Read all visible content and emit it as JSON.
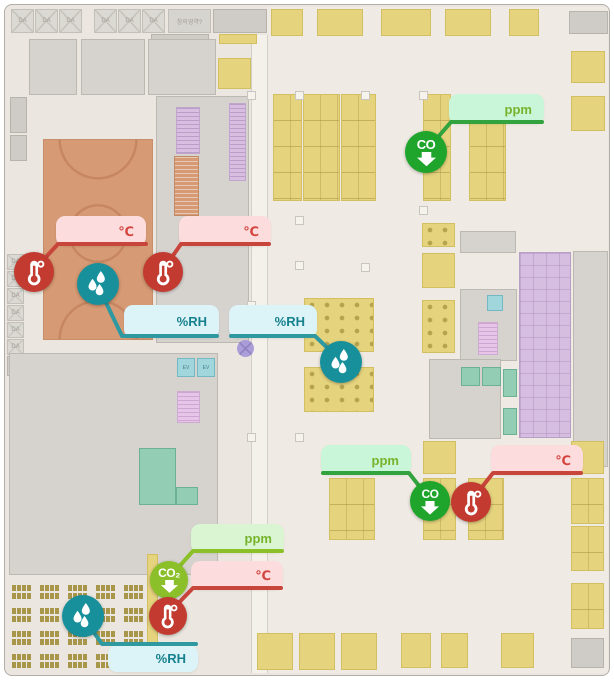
{
  "window": {
    "type": "facility-floor-plan-monitoring-view"
  },
  "labels": {
    "da": "DA",
    "ev": "EV",
    "co": "CO",
    "co2": "CO₂",
    "top_strip_text": "창의영역?"
  },
  "units": {
    "temperature": "℃",
    "humidity": "%RH",
    "gas": "ppm"
  },
  "palette": {
    "temperature": {
      "marker": "#c23a30",
      "bubble": "#fcdcdc",
      "text": "#d4453f",
      "line": "#c8453c"
    },
    "humidity": {
      "marker": "#17909b",
      "bubble": "#dcf3f8",
      "text": "#17818d",
      "line": "#2f99a2"
    },
    "co": {
      "marker": "#1fa52c",
      "bubble": "#c9f6d9",
      "text": "#76b32b",
      "line": "#33a33f"
    },
    "co2": {
      "marker": "#8cc02a",
      "bubble": "#d9f5d2",
      "text": "#76b32b",
      "line": "#8cc029"
    }
  },
  "map_colors": {
    "floor": "#ebe7e0",
    "room_grey": "#d6d3cf",
    "table": "#e5d37d",
    "gym": "#d69a74",
    "purple": "#d6bee0",
    "teal": "#92cdb4",
    "seat": "#a8974b",
    "cyan": "#a2d6dd"
  },
  "plan": {
    "rects": [
      {
        "k": "floor-light",
        "x": 266,
        "y": 6,
        "w": 341,
        "h": 666
      },
      {
        "k": "corridor",
        "x": 250,
        "y": 34,
        "w": 17,
        "h": 638
      },
      {
        "k": "box-da",
        "x": 10,
        "y": 8,
        "w": 23,
        "h": 24,
        "label": "DA"
      },
      {
        "k": "box-da",
        "x": 34,
        "y": 8,
        "w": 23,
        "h": 24,
        "label": "DA"
      },
      {
        "k": "box-da",
        "x": 58,
        "y": 8,
        "w": 23,
        "h": 24,
        "label": "DA"
      },
      {
        "k": "box-da",
        "x": 93,
        "y": 8,
        "w": 23,
        "h": 24,
        "label": "DA"
      },
      {
        "k": "box-da",
        "x": 117,
        "y": 8,
        "w": 23,
        "h": 24,
        "label": "DA"
      },
      {
        "k": "box-da",
        "x": 141,
        "y": 8,
        "w": 23,
        "h": 24,
        "label": "DA"
      },
      {
        "k": "box-label",
        "x": 167,
        "y": 8,
        "w": 43,
        "h": 24,
        "label": "창의영역?"
      },
      {
        "k": "room-grey-dark",
        "x": 212,
        "y": 8,
        "w": 54,
        "h": 24
      },
      {
        "k": "room-grey-dark",
        "x": 150,
        "y": 33,
        "w": 58,
        "h": 10
      },
      {
        "k": "table",
        "x": 218,
        "y": 33,
        "w": 38,
        "h": 10
      },
      {
        "k": "room-grey",
        "x": 28,
        "y": 38,
        "w": 48,
        "h": 56
      },
      {
        "k": "room-grey",
        "x": 80,
        "y": 38,
        "w": 64,
        "h": 56
      },
      {
        "k": "room-grey",
        "x": 147,
        "y": 38,
        "w": 68,
        "h": 56
      },
      {
        "k": "table",
        "x": 217,
        "y": 57,
        "w": 33,
        "h": 31
      },
      {
        "k": "room-grey-dark",
        "x": 9,
        "y": 96,
        "w": 17,
        "h": 36
      },
      {
        "k": "room-grey-dark",
        "x": 9,
        "y": 134,
        "w": 17,
        "h": 26
      },
      {
        "k": "box-da",
        "x": 6,
        "y": 253,
        "w": 17,
        "h": 16,
        "label": "DA"
      },
      {
        "k": "box-da",
        "x": 6,
        "y": 270,
        "w": 17,
        "h": 16,
        "label": "DA"
      },
      {
        "k": "box-da",
        "x": 6,
        "y": 287,
        "w": 17,
        "h": 16,
        "label": "DA"
      },
      {
        "k": "box-da",
        "x": 6,
        "y": 304,
        "w": 17,
        "h": 16,
        "label": "DA"
      },
      {
        "k": "box-da",
        "x": 6,
        "y": 321,
        "w": 17,
        "h": 16,
        "label": "DA"
      },
      {
        "k": "box-da",
        "x": 6,
        "y": 338,
        "w": 17,
        "h": 16,
        "label": "DA"
      },
      {
        "k": "room-grey-dark",
        "x": 6,
        "y": 355,
        "w": 18,
        "h": 20
      },
      {
        "k": "gym",
        "x": 42,
        "y": 138,
        "w": 110,
        "h": 201
      },
      {
        "k": "room-grey",
        "x": 155,
        "y": 95,
        "w": 93,
        "h": 247
      },
      {
        "k": "stairs-lav",
        "x": 175,
        "y": 106,
        "w": 24,
        "h": 47
      },
      {
        "k": "stairs-lav",
        "x": 228,
        "y": 102,
        "w": 17,
        "h": 78
      },
      {
        "k": "esc-orange",
        "x": 173,
        "y": 155,
        "w": 25,
        "h": 60
      },
      {
        "k": "room-grey",
        "x": 8,
        "y": 352,
        "w": 209,
        "h": 222
      },
      {
        "k": "elev-cyan",
        "x": 176,
        "y": 357,
        "w": 18,
        "h": 19,
        "label": "EV"
      },
      {
        "k": "elev-cyan",
        "x": 196,
        "y": 357,
        "w": 18,
        "h": 19,
        "label": "EV"
      },
      {
        "k": "stairs-pink",
        "x": 176,
        "y": 390,
        "w": 23,
        "h": 32
      },
      {
        "k": "teal",
        "x": 138,
        "y": 447,
        "w": 37,
        "h": 57
      },
      {
        "k": "teal",
        "x": 175,
        "y": 486,
        "w": 22,
        "h": 18
      },
      {
        "k": "seats-grid",
        "x": 10,
        "y": 583,
        "cols": 5,
        "rows": 4,
        "dx": 28,
        "dy": 23,
        "w": 24,
        "h": 16
      },
      {
        "k": "table",
        "x": 146,
        "y": 553,
        "w": 11,
        "h": 117
      },
      {
        "k": "xcircle",
        "x": 236,
        "y": 339,
        "w": 17,
        "h": 17
      },
      {
        "k": "table",
        "x": 270,
        "y": 8,
        "w": 32,
        "h": 27
      },
      {
        "k": "table",
        "x": 316,
        "y": 8,
        "w": 46,
        "h": 27
      },
      {
        "k": "table",
        "x": 380,
        "y": 8,
        "w": 50,
        "h": 27
      },
      {
        "k": "table",
        "x": 444,
        "y": 8,
        "w": 46,
        "h": 27
      },
      {
        "k": "table",
        "x": 508,
        "y": 8,
        "w": 30,
        "h": 27
      },
      {
        "k": "room-grey-dark",
        "x": 568,
        "y": 10,
        "w": 39,
        "h": 23
      },
      {
        "k": "table",
        "x": 570,
        "y": 50,
        "w": 34,
        "h": 32
      },
      {
        "k": "table",
        "x": 570,
        "y": 95,
        "w": 34,
        "h": 35
      },
      {
        "k": "table-grid",
        "x": 272,
        "y": 93,
        "w": 29,
        "h": 107
      },
      {
        "k": "table-grid",
        "x": 302,
        "y": 93,
        "w": 37,
        "h": 107
      },
      {
        "k": "table-grid",
        "x": 340,
        "y": 93,
        "w": 35,
        "h": 107
      },
      {
        "k": "table-grid",
        "x": 422,
        "y": 93,
        "w": 28,
        "h": 107
      },
      {
        "k": "table-grid",
        "x": 468,
        "y": 93,
        "w": 37,
        "h": 107
      },
      {
        "k": "table-icons",
        "x": 303,
        "y": 297,
        "w": 70,
        "h": 54
      },
      {
        "k": "table-icons",
        "x": 303,
        "y": 366,
        "w": 70,
        "h": 45
      },
      {
        "k": "table-icons",
        "x": 421,
        "y": 222,
        "w": 33,
        "h": 24
      },
      {
        "k": "table",
        "x": 421,
        "y": 252,
        "w": 33,
        "h": 35
      },
      {
        "k": "table-icons",
        "x": 421,
        "y": 299,
        "w": 33,
        "h": 53
      },
      {
        "k": "room-grey",
        "x": 459,
        "y": 230,
        "w": 56,
        "h": 22
      },
      {
        "k": "room-grey",
        "x": 459,
        "y": 288,
        "w": 57,
        "h": 72
      },
      {
        "k": "elev-cyan",
        "x": 486,
        "y": 294,
        "w": 16,
        "h": 16
      },
      {
        "k": "stairs-pink",
        "x": 477,
        "y": 321,
        "w": 20,
        "h": 33
      },
      {
        "k": "room-grey",
        "x": 428,
        "y": 358,
        "w": 72,
        "h": 80
      },
      {
        "k": "teal",
        "x": 460,
        "y": 366,
        "w": 19,
        "h": 19
      },
      {
        "k": "teal",
        "x": 481,
        "y": 366,
        "w": 19,
        "h": 19
      },
      {
        "k": "teal",
        "x": 502,
        "y": 368,
        "w": 14,
        "h": 28
      },
      {
        "k": "teal",
        "x": 502,
        "y": 407,
        "w": 14,
        "h": 27
      },
      {
        "k": "purple",
        "x": 518,
        "y": 251,
        "w": 52,
        "h": 186
      },
      {
        "k": "room-grey",
        "x": 572,
        "y": 250,
        "w": 35,
        "h": 216
      },
      {
        "k": "table",
        "x": 422,
        "y": 440,
        "w": 33,
        "h": 33
      },
      {
        "k": "table-grid",
        "x": 328,
        "y": 477,
        "w": 46,
        "h": 62
      },
      {
        "k": "table-grid",
        "x": 422,
        "y": 477,
        "w": 33,
        "h": 62
      },
      {
        "k": "table-grid",
        "x": 467,
        "y": 477,
        "w": 36,
        "h": 62
      },
      {
        "k": "table",
        "x": 570,
        "y": 440,
        "w": 33,
        "h": 33
      },
      {
        "k": "table-grid",
        "x": 570,
        "y": 477,
        "w": 33,
        "h": 46
      },
      {
        "k": "table-grid",
        "x": 570,
        "y": 525,
        "w": 33,
        "h": 45
      },
      {
        "k": "table-grid",
        "x": 570,
        "y": 582,
        "w": 33,
        "h": 46
      },
      {
        "k": "room-grey-dark",
        "x": 570,
        "y": 637,
        "w": 33,
        "h": 30
      },
      {
        "k": "table",
        "x": 256,
        "y": 632,
        "w": 36,
        "h": 37
      },
      {
        "k": "table",
        "x": 298,
        "y": 632,
        "w": 36,
        "h": 37
      },
      {
        "k": "table",
        "x": 340,
        "y": 632,
        "w": 36,
        "h": 37
      },
      {
        "k": "table",
        "x": 400,
        "y": 632,
        "w": 30,
        "h": 35
      },
      {
        "k": "table",
        "x": 440,
        "y": 632,
        "w": 27,
        "h": 35
      },
      {
        "k": "table",
        "x": 500,
        "y": 632,
        "w": 33,
        "h": 35
      },
      {
        "k": "pillar",
        "x": 246,
        "y": 90,
        "w": 9,
        "h": 9
      },
      {
        "k": "pillar",
        "x": 294,
        "y": 90,
        "w": 9,
        "h": 9
      },
      {
        "k": "pillar",
        "x": 360,
        "y": 90,
        "w": 9,
        "h": 9
      },
      {
        "k": "pillar",
        "x": 418,
        "y": 90,
        "w": 9,
        "h": 9
      },
      {
        "k": "pillar",
        "x": 246,
        "y": 215,
        "w": 9,
        "h": 9
      },
      {
        "k": "pillar",
        "x": 294,
        "y": 215,
        "w": 9,
        "h": 9
      },
      {
        "k": "pillar",
        "x": 418,
        "y": 205,
        "w": 9,
        "h": 9
      },
      {
        "k": "pillar",
        "x": 246,
        "y": 300,
        "w": 9,
        "h": 9
      },
      {
        "k": "pillar",
        "x": 294,
        "y": 260,
        "w": 9,
        "h": 9
      },
      {
        "k": "pillar",
        "x": 360,
        "y": 262,
        "w": 9,
        "h": 9
      },
      {
        "k": "pillar",
        "x": 246,
        "y": 432,
        "w": 9,
        "h": 9
      },
      {
        "k": "pillar",
        "x": 294,
        "y": 432,
        "w": 9,
        "h": 9
      }
    ]
  },
  "sensors": {
    "markers": [
      {
        "id": "temp-1",
        "kind": "temperature",
        "x": 33,
        "y": 271,
        "r": 20
      },
      {
        "id": "hum-1",
        "kind": "humidity",
        "x": 97,
        "y": 283,
        "r": 21
      },
      {
        "id": "temp-2",
        "kind": "temperature",
        "x": 162,
        "y": 271,
        "r": 20
      },
      {
        "id": "hum-2",
        "kind": "humidity",
        "x": 340,
        "y": 361,
        "r": 21
      },
      {
        "id": "co-1",
        "kind": "co",
        "x": 425,
        "y": 151,
        "r": 21
      },
      {
        "id": "co2-1",
        "kind": "co2",
        "x": 168,
        "y": 579,
        "r": 19
      },
      {
        "id": "temp-3",
        "kind": "temperature",
        "x": 167,
        "y": 615,
        "r": 19
      },
      {
        "id": "hum-3",
        "kind": "humidity",
        "x": 82,
        "y": 615,
        "r": 21
      },
      {
        "id": "co-2",
        "kind": "co",
        "x": 429,
        "y": 500,
        "r": 20
      },
      {
        "id": "temp-4",
        "kind": "temperature",
        "x": 470,
        "y": 501,
        "r": 20
      }
    ],
    "bubbles": [
      {
        "id": "b-temp-1",
        "kind": "temperature",
        "x": 55,
        "y": 215,
        "w": 90,
        "h": 30,
        "label": "℃"
      },
      {
        "id": "b-temp-2",
        "kind": "temperature",
        "x": 178,
        "y": 215,
        "w": 92,
        "h": 30,
        "label": "℃"
      },
      {
        "id": "b-hum-1",
        "kind": "humidity",
        "x": 123,
        "y": 304,
        "w": 95,
        "h": 33,
        "label": "%RH"
      },
      {
        "id": "b-hum-2",
        "kind": "humidity",
        "x": 228,
        "y": 304,
        "w": 88,
        "h": 33,
        "label": "%RH"
      },
      {
        "id": "b-co-1",
        "kind": "co",
        "x": 448,
        "y": 93,
        "w": 95,
        "h": 30,
        "label": "ppm"
      },
      {
        "id": "b-co2-1",
        "kind": "co2",
        "x": 190,
        "y": 523,
        "w": 93,
        "h": 29,
        "label": "ppm"
      },
      {
        "id": "b-temp-3",
        "kind": "temperature",
        "x": 190,
        "y": 560,
        "w": 92,
        "h": 29,
        "label": "℃"
      },
      {
        "id": "b-hum-3",
        "kind": "humidity",
        "x": 107,
        "y": 644,
        "w": 90,
        "h": 27,
        "label": "%RH"
      },
      {
        "id": "b-co-2",
        "kind": "co",
        "x": 320,
        "y": 444,
        "w": 90,
        "h": 30,
        "label": "ppm"
      },
      {
        "id": "b-temp-4",
        "kind": "temperature",
        "x": 490,
        "y": 444,
        "w": 92,
        "h": 30,
        "label": "℃"
      }
    ],
    "lines": [
      {
        "kind": "temperature",
        "points": "145,243 57,243 33,269"
      },
      {
        "kind": "temperature",
        "points": "268,243 180,243 162,269"
      },
      {
        "kind": "humidity",
        "points": "97,285 121,335 216,335"
      },
      {
        "kind": "humidity",
        "points": "230,335 314,335 340,360"
      },
      {
        "kind": "co",
        "points": "541,121 450,121 425,150"
      },
      {
        "kind": "co2",
        "points": "281,550 192,550 168,577"
      },
      {
        "kind": "temperature",
        "points": "280,587 192,587 167,613"
      },
      {
        "kind": "humidity",
        "points": "82,616 101,643 195,643"
      },
      {
        "kind": "co",
        "points": "322,472 408,472 429,499"
      },
      {
        "kind": "temperature",
        "points": "580,472 492,472 470,500"
      }
    ]
  }
}
